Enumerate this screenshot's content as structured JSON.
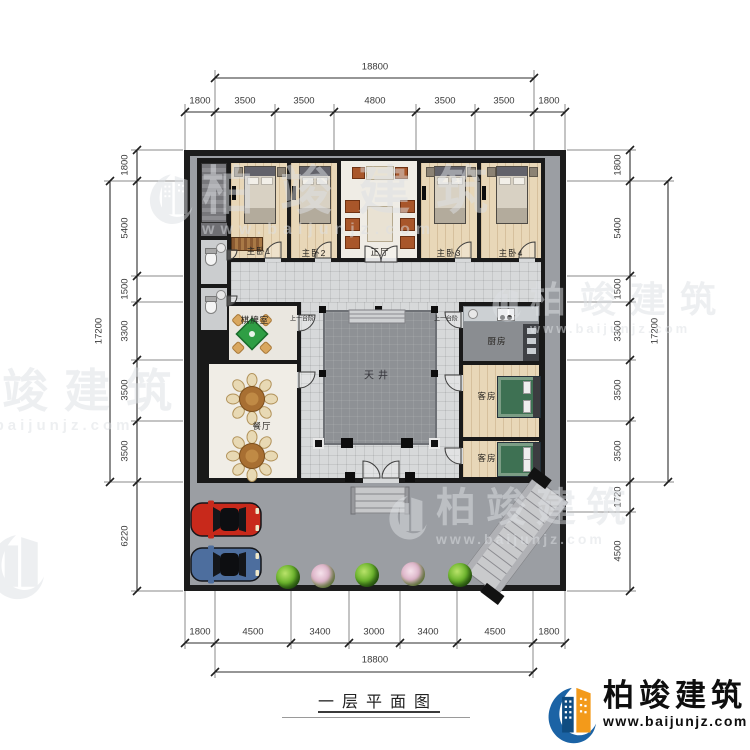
{
  "title": {
    "text": "一层平面图"
  },
  "brand": {
    "name": "柏竣建筑",
    "url": "www.baijunjz.com"
  },
  "watermark": {
    "title": "柏竣建筑",
    "url": "www.baijunjz.com"
  },
  "dims": {
    "top": {
      "overall": "18800",
      "segments": [
        "1800",
        "3500",
        "3500",
        "4800",
        "3500",
        "3500",
        "1800"
      ]
    },
    "bottom": {
      "overall": "18800",
      "segments": [
        "1800",
        "4500",
        "3400",
        "3000",
        "3400",
        "4500",
        "1800"
      ]
    },
    "left": {
      "overall": "17200",
      "segments": [
        "1800",
        "5400",
        "1500",
        "3300",
        "3500",
        "3500",
        "6220"
      ]
    },
    "right": {
      "overall": "17200",
      "segments": [
        "1800",
        "5400",
        "1500",
        "3300",
        "3500",
        "3500",
        "1720",
        "4500"
      ]
    }
  },
  "rooms": {
    "master1": "主卧1",
    "master2": "主卧2",
    "hall": "正厅",
    "master3": "主卧3",
    "master4": "主卧4",
    "chess": "棋牌室",
    "dining": "餐厅",
    "kitchen": "厨房",
    "guest1": "客房",
    "guest2": "客房",
    "courtyard": "天井",
    "step_left": "上一台阶",
    "step_right": "上一台阶"
  },
  "colors": {
    "wall": "#1c1c1c",
    "yard": "#9b9ea3",
    "corridor": "#d7d9da",
    "courtyard": "#8e9195",
    "wood_floor": "#e8d7b8",
    "hall_floor": "#efece5",
    "kitchen_floor": "#8a8d91",
    "logo_blue": "#1b63a5",
    "logo_orange": "#f39a1a",
    "car_red": "#c8291b",
    "car_blue": "#4d6e9e",
    "bed_green": "#3e7153",
    "bush_green": "#5da525",
    "bush_pink": "#dcb4c8"
  }
}
